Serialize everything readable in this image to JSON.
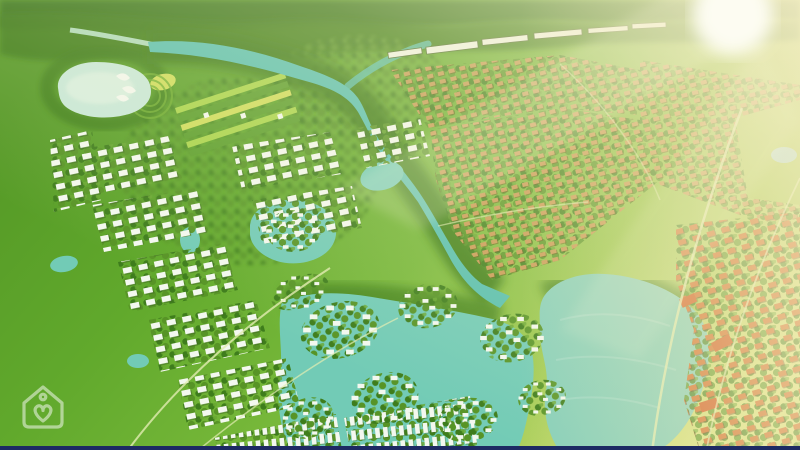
{
  "scene": {
    "type": "aerial-3d-masterplan-render",
    "description": "Bird's-eye 3D rendering of a green master-planned township with winding river, lakes, villa clusters and sunlit horizon",
    "watermark_icon": "house-heart-icon"
  },
  "colors": {
    "field_dark": "#549826",
    "field": "#61a92c",
    "field_mid": "#77b83a",
    "field_light": "#9cc94f",
    "field_sunlit": "#c6da72",
    "field_edge": "#d8e382",
    "forest_band": "#336f16",
    "foliage_dark": "#3e7d1c",
    "foliage_mid": "#579426",
    "foliage_light": "#69a832",
    "tree_margin": "#3a7a19",
    "river": "#57bfae",
    "lagoon": "#72cbb6",
    "lake_central": "#85cfba",
    "lake_pale": "#c8e8d8",
    "lake_pale_light": "#dff2e2",
    "stream_pale": "#b9e3cb",
    "pond_blue": "#a5d9e4",
    "roof_white": "#f3f8ef",
    "roof_shadow": "#3c6420",
    "roof_tan": "#c89a54",
    "tan_shadow": "#6b4a14",
    "roof_orange": "#d06e2c",
    "orange_shadow": "#5e3311",
    "building_orange": "#cf5a22",
    "resort_roof": "#eef3e6",
    "road": "#e2ecb2",
    "stripe_light": "#a8d44a",
    "stripe_dark": "#5a9e2b",
    "stripe_yellow": "#cddc5a",
    "golf_green": "#a6cd55",
    "sun_core": "#fffef6",
    "sun_haze": "#f8eec0",
    "watermark": "#ffffff",
    "bottom_bar": "#1d2a63"
  }
}
